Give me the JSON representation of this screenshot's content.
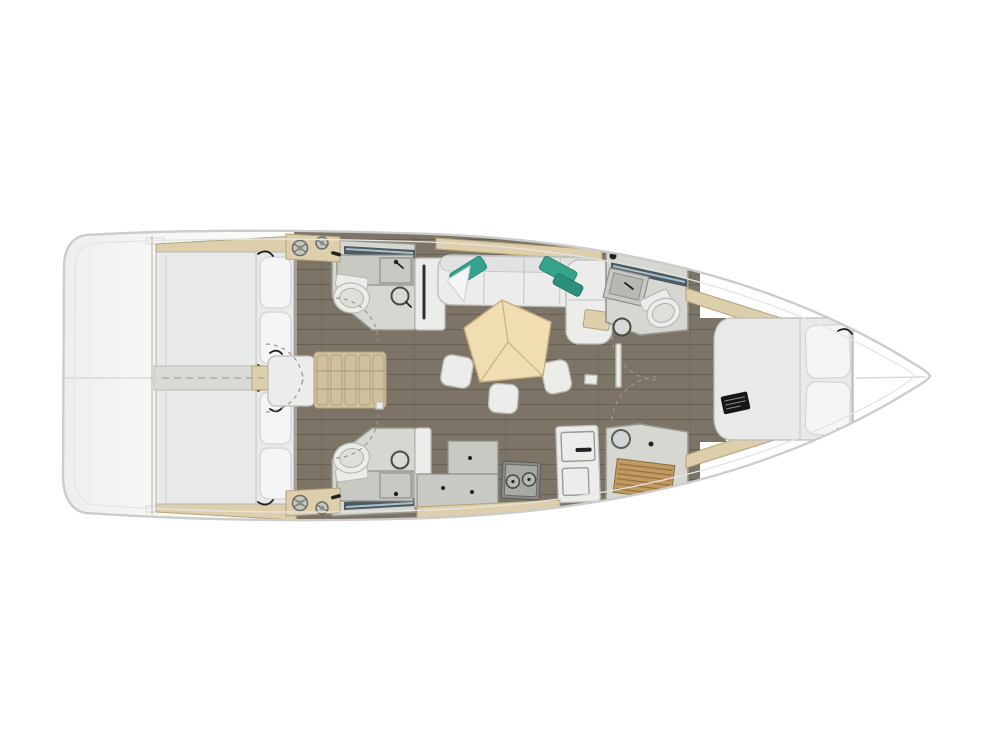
{
  "palette": {
    "background": "#ffffff",
    "hull_stroke": "#cccccc",
    "hull_inner_line": "#e4e4e2",
    "stern_shade": "#efefee",
    "deck_white": "#fdfdfc",
    "floor_wood": "#7d7468",
    "floor_line": "#685f54",
    "wet_room_floor": "#d7d7d2",
    "wet_room_wall": "#96968e",
    "furniture_white": "#ececeb",
    "furniture_stroke": "#bcbcb6",
    "mattress": "#e8e9e9",
    "pillow": "#f5f5f7",
    "pillow_stroke": "#d3d3d4",
    "beige": "#ddcfac",
    "beige_stroke": "#b3a27b",
    "stair_tread": "#cfc19f",
    "table_top": "#f0ddb2",
    "table_stroke": "#c8b083",
    "teal_cushion": "#35a38c",
    "teal_cushion_dark": "#2b8f7b",
    "teak_grate": "#c09a62",
    "teak_line": "#97763f",
    "window_glass": "#4d5a62",
    "window_glint": "#aabfc8",
    "counter_gray": "#c9c9c3",
    "stove_body": "#8b8b85",
    "stove_panel": "#a9a9a3",
    "hardware_dark": "#222222",
    "swing_arc": "#9b968b",
    "corridor": "#d9d9d6"
  },
  "scene": {
    "type": "sailing-yacht-interior-floor-plan",
    "view": "top-down",
    "bow_direction": "right",
    "rooms": [
      {
        "name": "aft-cabin-port",
        "features": [
          "double-berth",
          "2-pillows",
          "shelf"
        ]
      },
      {
        "name": "aft-cabin-starboard",
        "features": [
          "double-berth",
          "2-pillows",
          "shelf"
        ]
      },
      {
        "name": "aft-head-port",
        "features": [
          "toilet",
          "round-washbasin",
          "sink-counter",
          "hull-window"
        ]
      },
      {
        "name": "aft-head-starboard",
        "features": [
          "toilet",
          "round-washbasin",
          "sink-counter",
          "hull-window"
        ]
      },
      {
        "name": "saloon",
        "features": [
          "u-sofa",
          "2-teal-cushions",
          "white-cushion",
          "pentagon-table",
          "3-stools",
          "side-shelf"
        ]
      },
      {
        "name": "galley",
        "features": [
          "stepped-counter",
          "2-burner-stove",
          "tall-fridge-cabinet"
        ]
      },
      {
        "name": "forward-head-port",
        "features": [
          "toilet",
          "round-washbasin",
          "vanity",
          "hull-window"
        ]
      },
      {
        "name": "forward-shower-starboard",
        "features": [
          "teak-grating",
          "porthole"
        ]
      },
      {
        "name": "forward-cabin",
        "features": [
          "island-berth",
          "2-pillows",
          "black-bag",
          "side-benches"
        ]
      }
    ],
    "deck_items": [
      "stern-platform",
      "companionway-stairs",
      "landing-platform",
      "4-winches",
      "2-winch-pads",
      "bow-deck"
    ],
    "door_swing_arcs": 6
  }
}
